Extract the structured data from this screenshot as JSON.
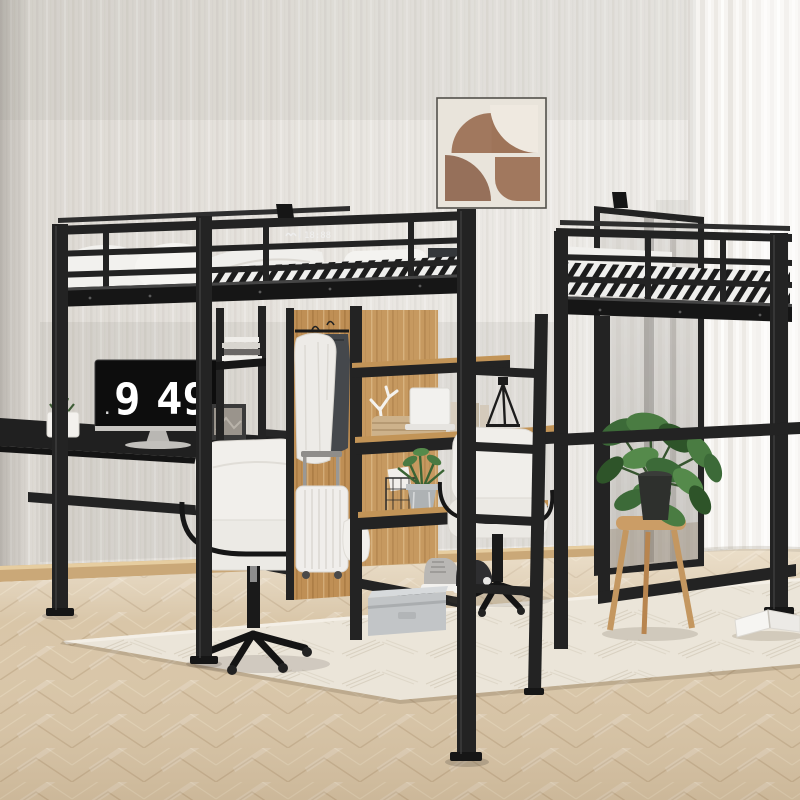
{
  "scene": {
    "description": "Black metal full-size loft bed with under-bed desks, wardrobe and staircase shelving in a bright bedroom",
    "monitor_clock": {
      "hour": "9",
      "minutes": "49",
      "dot": "."
    },
    "rail_display": {
      "text": "18:88"
    }
  },
  "palette": {
    "frame_black": "#232323",
    "wall": "#e8e5e0",
    "curtain": "#f6f4f1",
    "floor_wood": "#d9c6a8",
    "rug": "#ebe5d9",
    "panel_oak": "#bf8f55",
    "art_brown": "#9e7459",
    "bedding_white": "#f2f1ee",
    "mattress_dark": "#34373a",
    "chair_white": "#f1efeb",
    "plant_green": "#46753f",
    "suitcase_white": "#f0eeeb",
    "storage_box_gray": "#c2c5c7",
    "baseboard": "#caa878"
  },
  "objects": [
    "striped-wallpaper",
    "sheer-curtain",
    "abstract-wall-art",
    "leaning-mirror",
    "loft-bed-frame",
    "guardrails",
    "ladder",
    "white-bedding",
    "striped-mattress-edge",
    "monitor-flip-clock",
    "left-desk",
    "office-chair-left",
    "office-chair-right",
    "wardrobe-oak-panels",
    "hanging-jackets",
    "suitcase",
    "staircase-shelf",
    "woven-basket",
    "coral-decor",
    "books",
    "potted-shelf-plant",
    "wire-basket",
    "sneakers",
    "storage-box",
    "laptop",
    "fiddle-leaf-plant",
    "wooden-stool",
    "herringbone-floor",
    "area-rug",
    "open-book"
  ]
}
